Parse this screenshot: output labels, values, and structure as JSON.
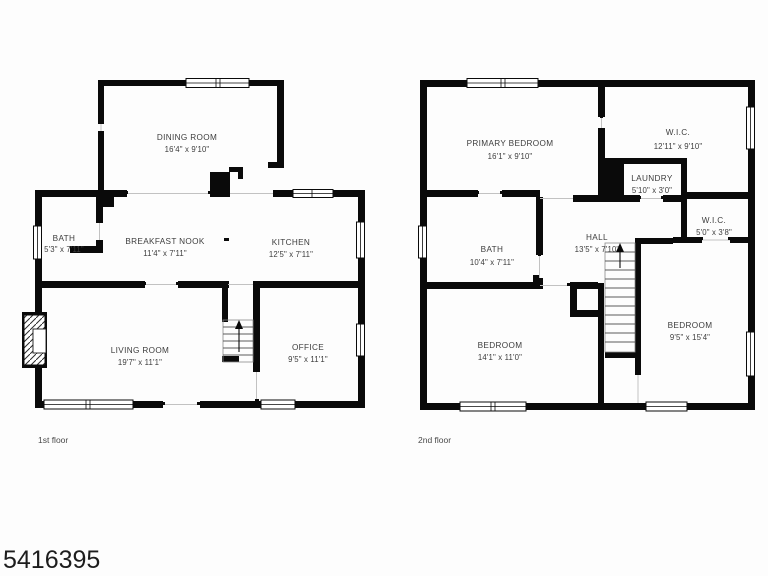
{
  "page": {
    "listing_id": "5416395",
    "background_color": "#fdfdfd",
    "wall_color": "#0a0a0a",
    "label_color": "#3d3d3d"
  },
  "features": {
    "stairs_first_floor": "stairs-up-arrow-icon",
    "stairs_second_floor": "stairs-up-arrow-icon",
    "fireplace_first_floor": "fireplace-icon"
  },
  "floors": [
    {
      "label": "1st floor",
      "rooms": [
        {
          "name": "DINING ROOM",
          "dims": "16'4\" x 9'10\""
        },
        {
          "name": "BATH",
          "dims": "5'3\" x 7'11\""
        },
        {
          "name": "BREAKFAST NOOK",
          "dims": "11'4\" x 7'11\""
        },
        {
          "name": "KITCHEN",
          "dims": "12'5\" x 7'11\""
        },
        {
          "name": "LIVING ROOM",
          "dims": "19'7\" x 11'1\""
        },
        {
          "name": "OFFICE",
          "dims": "9'5\" x 11'1\""
        }
      ]
    },
    {
      "label": "2nd floor",
      "rooms": [
        {
          "name": "PRIMARY BEDROOM",
          "dims": "16'1\" x 9'10\""
        },
        {
          "name": "W.I.C.",
          "dims": "12'11\" x 9'10\""
        },
        {
          "name": "LAUNDRY",
          "dims": "5'10\" x 3'0\""
        },
        {
          "name": "BATH",
          "dims": "10'4\" x 7'11\""
        },
        {
          "name": "HALL",
          "dims": "13'5\" x 7'10\""
        },
        {
          "name": "W.I.C.",
          "dims": "5'0\" x 3'8\""
        },
        {
          "name": "BEDROOM",
          "dims": "14'1\" x 11'0\""
        },
        {
          "name": "BEDROOM",
          "dims": "9'5\" x 15'4\""
        }
      ]
    }
  ]
}
